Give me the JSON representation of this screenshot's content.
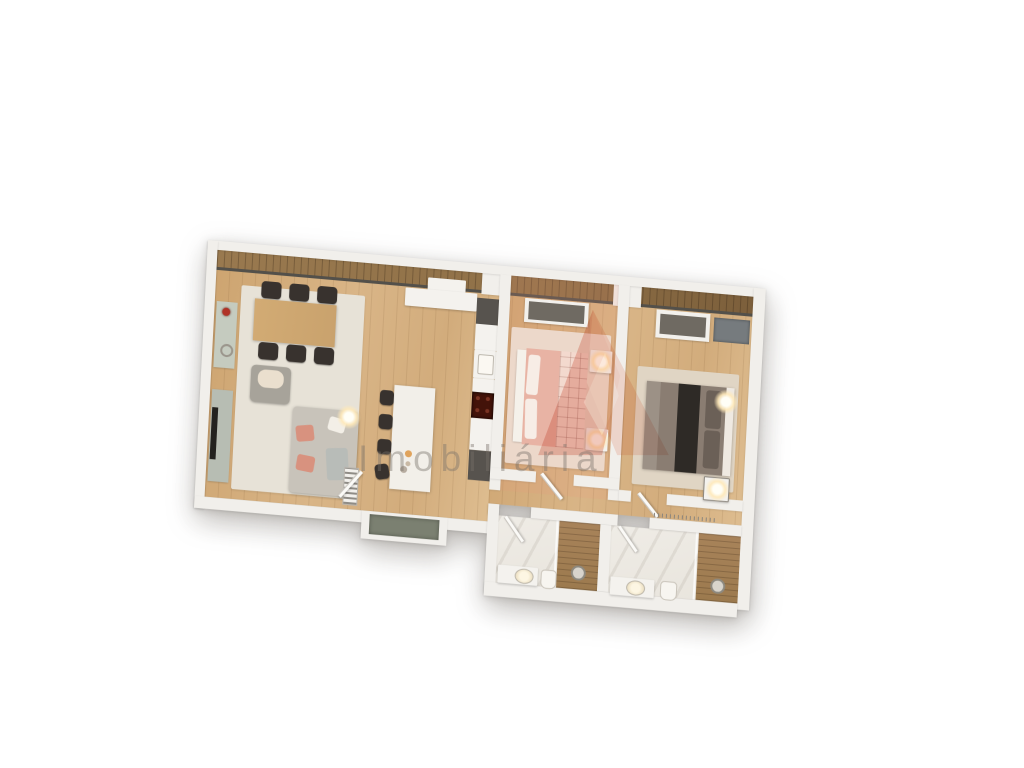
{
  "watermark": {
    "text": "Imobiliária"
  },
  "palette": {
    "wall": "#f1efeb",
    "wood": "#d2ac7c",
    "deck": "#8f7047",
    "rail": "#53504a",
    "rug": "#e7e2d7",
    "marble": "#e8e4dc",
    "shower_wood": "#9c7a4e",
    "island": "#f2efe9",
    "dark_furniture": "#38322e",
    "table_wood": "#c9a26d",
    "sofa": "#c8c3ba",
    "cushion": "#d8927f",
    "console": "#b7bdb3",
    "sideboard": "#c5cbbf",
    "tv": "#23221f",
    "counter_dark": "#57534e",
    "cooktop": "#431309",
    "bed1_duvet": "#e8b3a4",
    "bed1_quilt": "#f3d9ce",
    "bed2_base": "#8a7d72",
    "bed2_dark": "#2e2a26",
    "wardrobe_glass": "#6f6a62",
    "window_glass": "#767b7e",
    "niche_panel": "#7b8071",
    "sink_glow": "#f0e4c8",
    "flower_red": "#b03226",
    "accent_logo": "#dd7f6d",
    "accent_logo_light": "#f4c3b4",
    "wm_text": "rgba(120,113,105,0.42)"
  },
  "scene": {
    "type": "3d-floorplan-render",
    "rooms": [
      {
        "name": "living-dining-kitchen",
        "furniture": [
          "sideboard",
          "dining-table",
          "6-dining-chairs",
          "armchair",
          "corner-sofa",
          "tv-console",
          "radiator",
          "kitchen-island",
          "4-bar-stools",
          "kitchen-counter",
          "sink",
          "cooktop"
        ]
      },
      {
        "name": "bedroom-1",
        "furniture": [
          "double-bed",
          "2-nightstands",
          "2-lamps",
          "wardrobe",
          "rug"
        ]
      },
      {
        "name": "bedroom-2",
        "furniture": [
          "double-bed",
          "nightstand",
          "lamp",
          "wardrobe",
          "rug"
        ]
      },
      {
        "name": "bathroom-1",
        "furniture": [
          "vanity-sink",
          "toilet",
          "shower"
        ]
      },
      {
        "name": "bathroom-2",
        "furniture": [
          "vanity-sink",
          "toilet",
          "shower"
        ]
      },
      {
        "name": "balcony",
        "furniture": []
      },
      {
        "name": "hallway",
        "furniture": []
      },
      {
        "name": "entrance",
        "furniture": []
      }
    ]
  }
}
